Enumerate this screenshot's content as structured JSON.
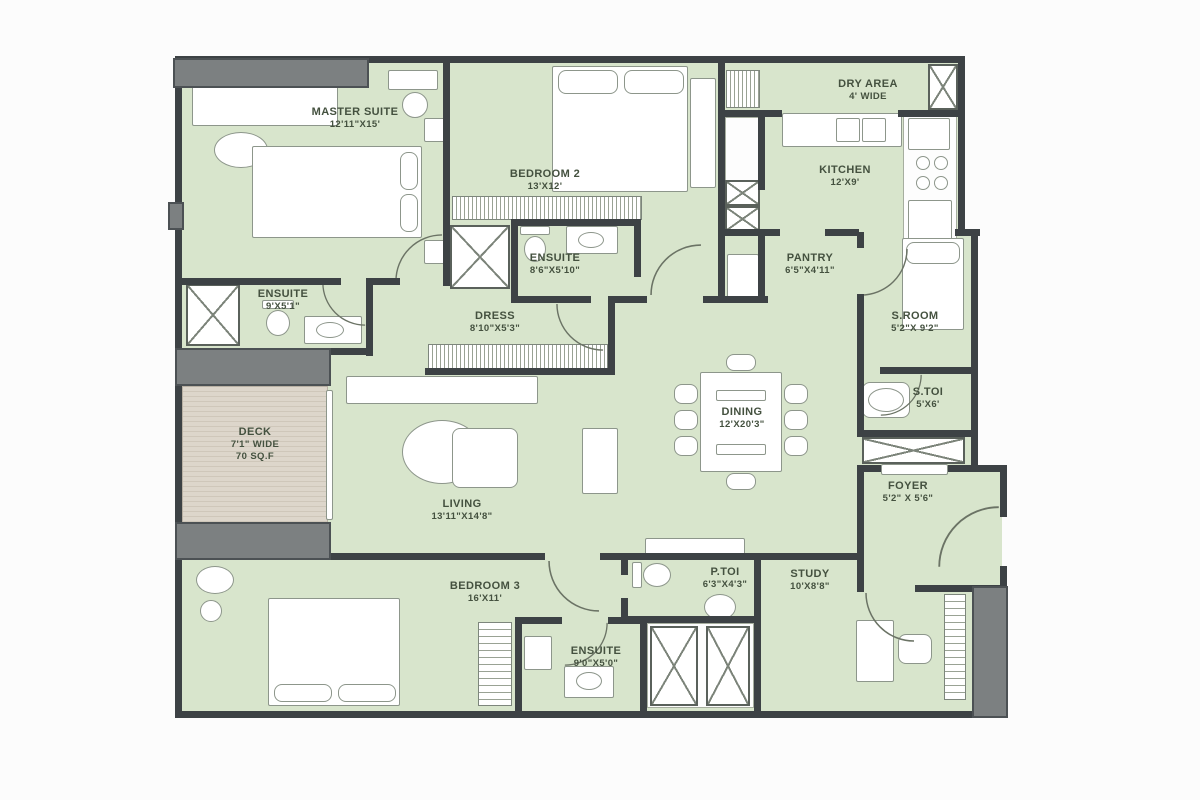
{
  "plan": {
    "rooms": {
      "master_suite": {
        "name": "MASTER SUITE",
        "dims": "12'11\"X15'"
      },
      "bedroom2": {
        "name": "BEDROOM 2",
        "dims": "13'X12'"
      },
      "ensuite_master": {
        "name": "ENSUITE",
        "dims": "9'X5'1\""
      },
      "ensuite_bedroom2": {
        "name": "ENSUITE",
        "dims": "8'6\"X5'10\""
      },
      "dress": {
        "name": "DRESS",
        "dims": "8'10\"X5'3\""
      },
      "dry_area": {
        "name": "DRY AREA",
        "dims": "4' WIDE"
      },
      "kitchen": {
        "name": "KITCHEN",
        "dims": "12'X9'"
      },
      "pantry": {
        "name": "PANTRY",
        "dims": "6'5\"X4'11\""
      },
      "s_room": {
        "name": "S.ROOM",
        "dims": "5'2\"X 9'2\""
      },
      "s_toi": {
        "name": "S.TOI",
        "dims": "5'X6'"
      },
      "deck": {
        "name": "DECK",
        "dims": "7'1\" WIDE",
        "area": "70 SQ.F"
      },
      "living": {
        "name": "LIVING",
        "dims": "13'11\"X14'8\""
      },
      "dining": {
        "name": "DINING",
        "dims": "12'X20'3\""
      },
      "foyer": {
        "name": "FOYER",
        "dims": "5'2\" X 5'6\""
      },
      "bedroom3": {
        "name": "BEDROOM 3",
        "dims": "16'X11'"
      },
      "ensuite_bedroom3": {
        "name": "ENSUITE",
        "dims": "9'0\"X5'0\""
      },
      "p_toi": {
        "name": "P.TOI",
        "dims": "6'3\"X4'3\""
      },
      "study": {
        "name": "STUDY",
        "dims": "10'X8'8\""
      }
    },
    "colors": {
      "room_fill": "#d8e5cc",
      "wall": "#3d4245",
      "slab_gray": "#7c8081",
      "deck_fill": "#ddd6cb",
      "label_text": "#44513f"
    }
  }
}
